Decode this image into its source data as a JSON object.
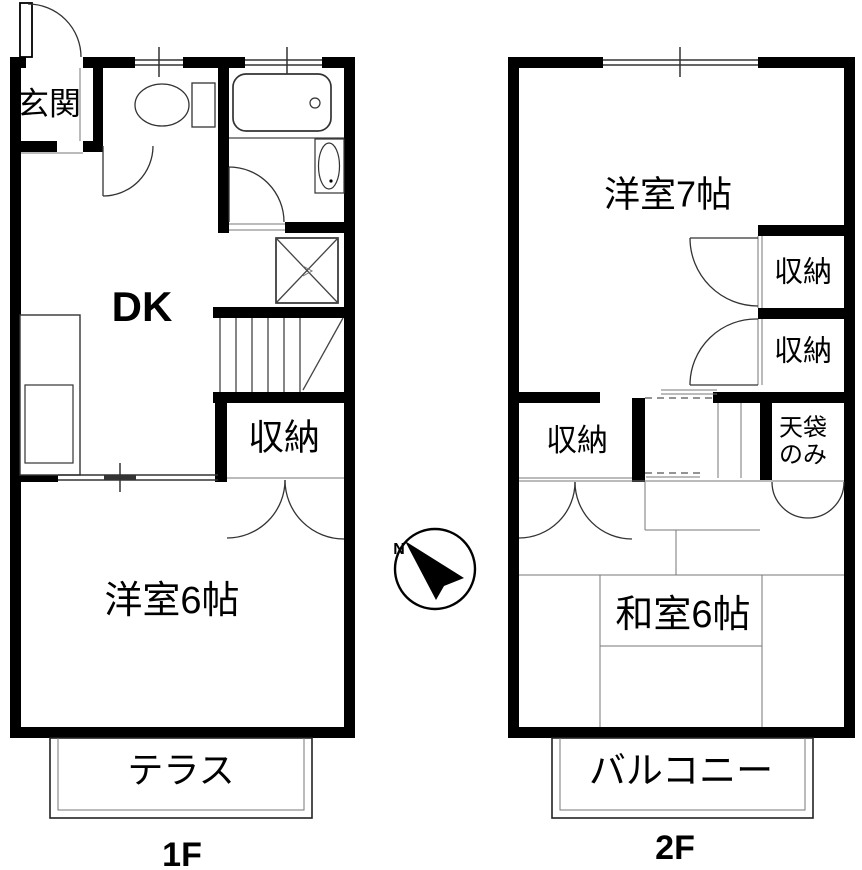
{
  "title": "2-story apartment floor plan",
  "floor1": {
    "label": "1F",
    "rooms": {
      "genkan": "玄関",
      "dk": "DK",
      "closet": "収納",
      "bedroom": "洋室6帖",
      "terrace": "テラス"
    }
  },
  "floor2": {
    "label": "2F",
    "rooms": {
      "bedroom": "洋室7帖",
      "closet_top": "収納",
      "closet_mid": "収納",
      "closet_left": "収納",
      "tenbukuro_line1": "天袋",
      "tenbukuro_line2": "のみ",
      "washitsu": "和室6帖",
      "balcony": "バルコニー"
    }
  },
  "compass": {
    "north": "N"
  },
  "colors": {
    "wall": "#000000",
    "line": "#555555",
    "background": "#ffffff",
    "text": "#000000"
  }
}
